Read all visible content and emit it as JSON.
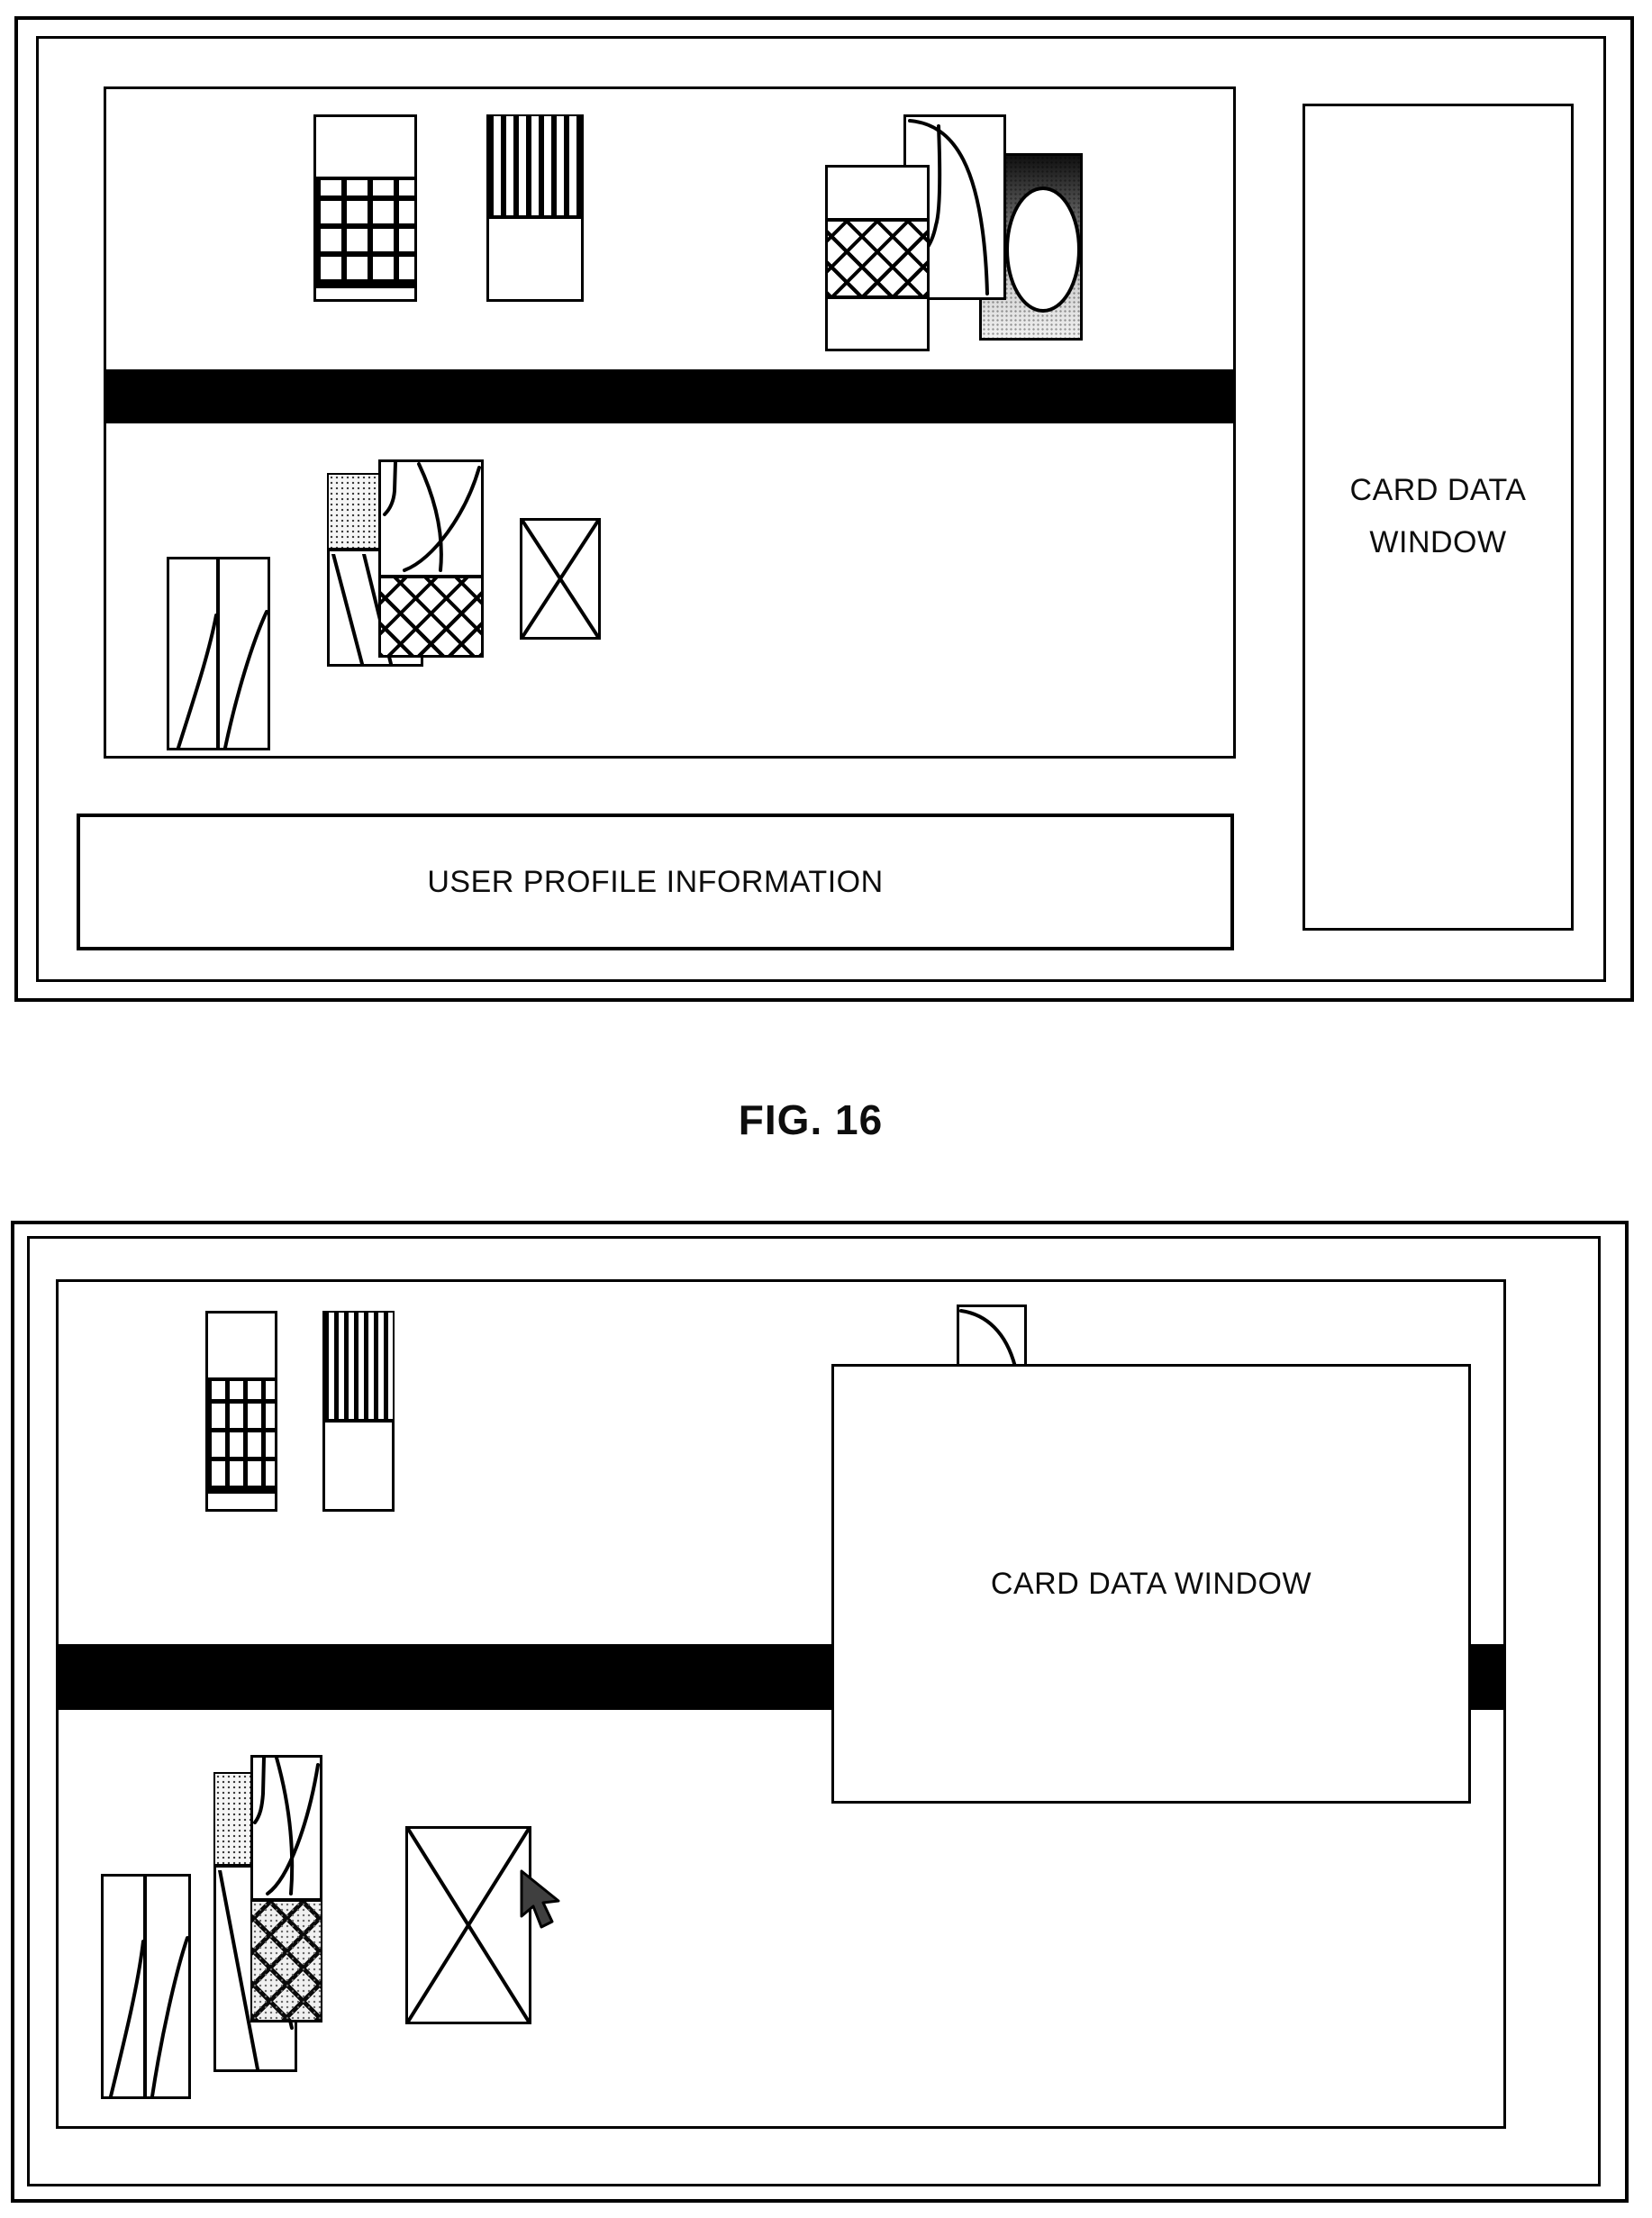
{
  "document": {
    "type": "patent-figure-sheet",
    "background": "#ffffff"
  },
  "colors": {
    "ink": "#000000",
    "card_fill": "#ffffff",
    "menu_bar": "#000000",
    "cursor_fill": "#3f3f3f"
  },
  "fig16": {
    "caption": "FIG. 16",
    "side_panel": {
      "line1": "CARD DATA",
      "line2": "WINDOW"
    },
    "user_profile_box": {
      "label": "USER PROFILE INFORMATION"
    },
    "menu_bar": "solid-black-strip",
    "card_icons": [
      "grid-pattern-card",
      "vertical-stripe-card",
      "diamond-hatch-card",
      "curve-sketch-card",
      "gradient-ellipse-card",
      "curve-left-card",
      "stipple-card",
      "curve-hatch-card",
      "x-envelope-card"
    ]
  },
  "fig17": {
    "popup": {
      "label": "CARD DATA WINDOW"
    },
    "menu_bar": "solid-black-strip",
    "cursor": "arrow-pointer",
    "card_icons": [
      "grid-pattern-card",
      "vertical-stripe-card",
      "hidden-card-behind-popup",
      "curve-left-card",
      "stipple-card",
      "curve-hatch-card",
      "x-envelope-card"
    ]
  }
}
